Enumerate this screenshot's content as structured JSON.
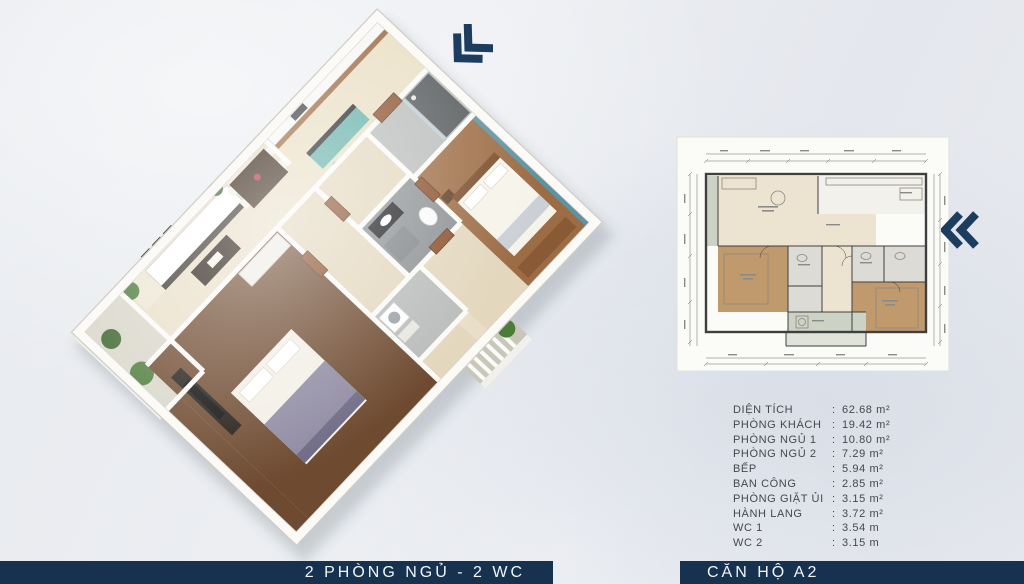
{
  "colors": {
    "navy": "#17324e",
    "bar_text": "#f2f6fa",
    "arrow": "#1c3d60",
    "bg": "#e9ebef",
    "spec_text": "#45484c",
    "cream": "#e9dfc8",
    "cream2": "#e3d7bd",
    "wood_mid": "#9c6c44",
    "wood_dark": "#6e4a30",
    "teal": "#63b0a8",
    "teal_wall": "#5d93a2",
    "bath": "#b9bcba",
    "bath_dark": "#8c9092",
    "wall_white": "#fbfaf7",
    "plant": "#4d7c3a",
    "plant_dark": "#3c662e",
    "door": "#8a4f2a",
    "balcony_floor": "#d9d6c9",
    "sheet": "#fbfbf8",
    "ink": "#3f3f3f",
    "dim_line": "#6a6a6a",
    "plan_wood": "#c09a6d",
    "plan_cream": "#ece4d0",
    "plan_bath": "#dddbd5",
    "plan_green": "#ccd3c6"
  },
  "bars": {
    "left_label": "2 PHÒNG NGỦ - 2 WC",
    "right_label": "CĂN HỘ A2"
  },
  "specs": {
    "separator": ":",
    "rows": [
      {
        "label": "DIỆN TÍCH",
        "value": "62.68 m²"
      },
      {
        "label": "PHÒNG KHÁCH",
        "value": "19.42 m²"
      },
      {
        "label": "PHÒNG NGỦ 1",
        "value": "10.80 m²"
      },
      {
        "label": "PHÒNG NGỦ 2",
        "value": "7.29 m²"
      },
      {
        "label": "BẾP",
        "value": "5.94 m²"
      },
      {
        "label": "BAN CÔNG",
        "value": "2.85 m²"
      },
      {
        "label": "PHÒNG GIẶT ỦI",
        "value": "3.15 m²"
      },
      {
        "label": "HÀNH LANG",
        "value": "3.72 m²"
      },
      {
        "label": "WC 1",
        "value": "3.54 m"
      },
      {
        "label": "WC 2",
        "value": "3.15 m"
      }
    ]
  },
  "icons": {
    "top_arrow": "double-chevron-down-left",
    "side_arrow": "double-chevron-left"
  }
}
